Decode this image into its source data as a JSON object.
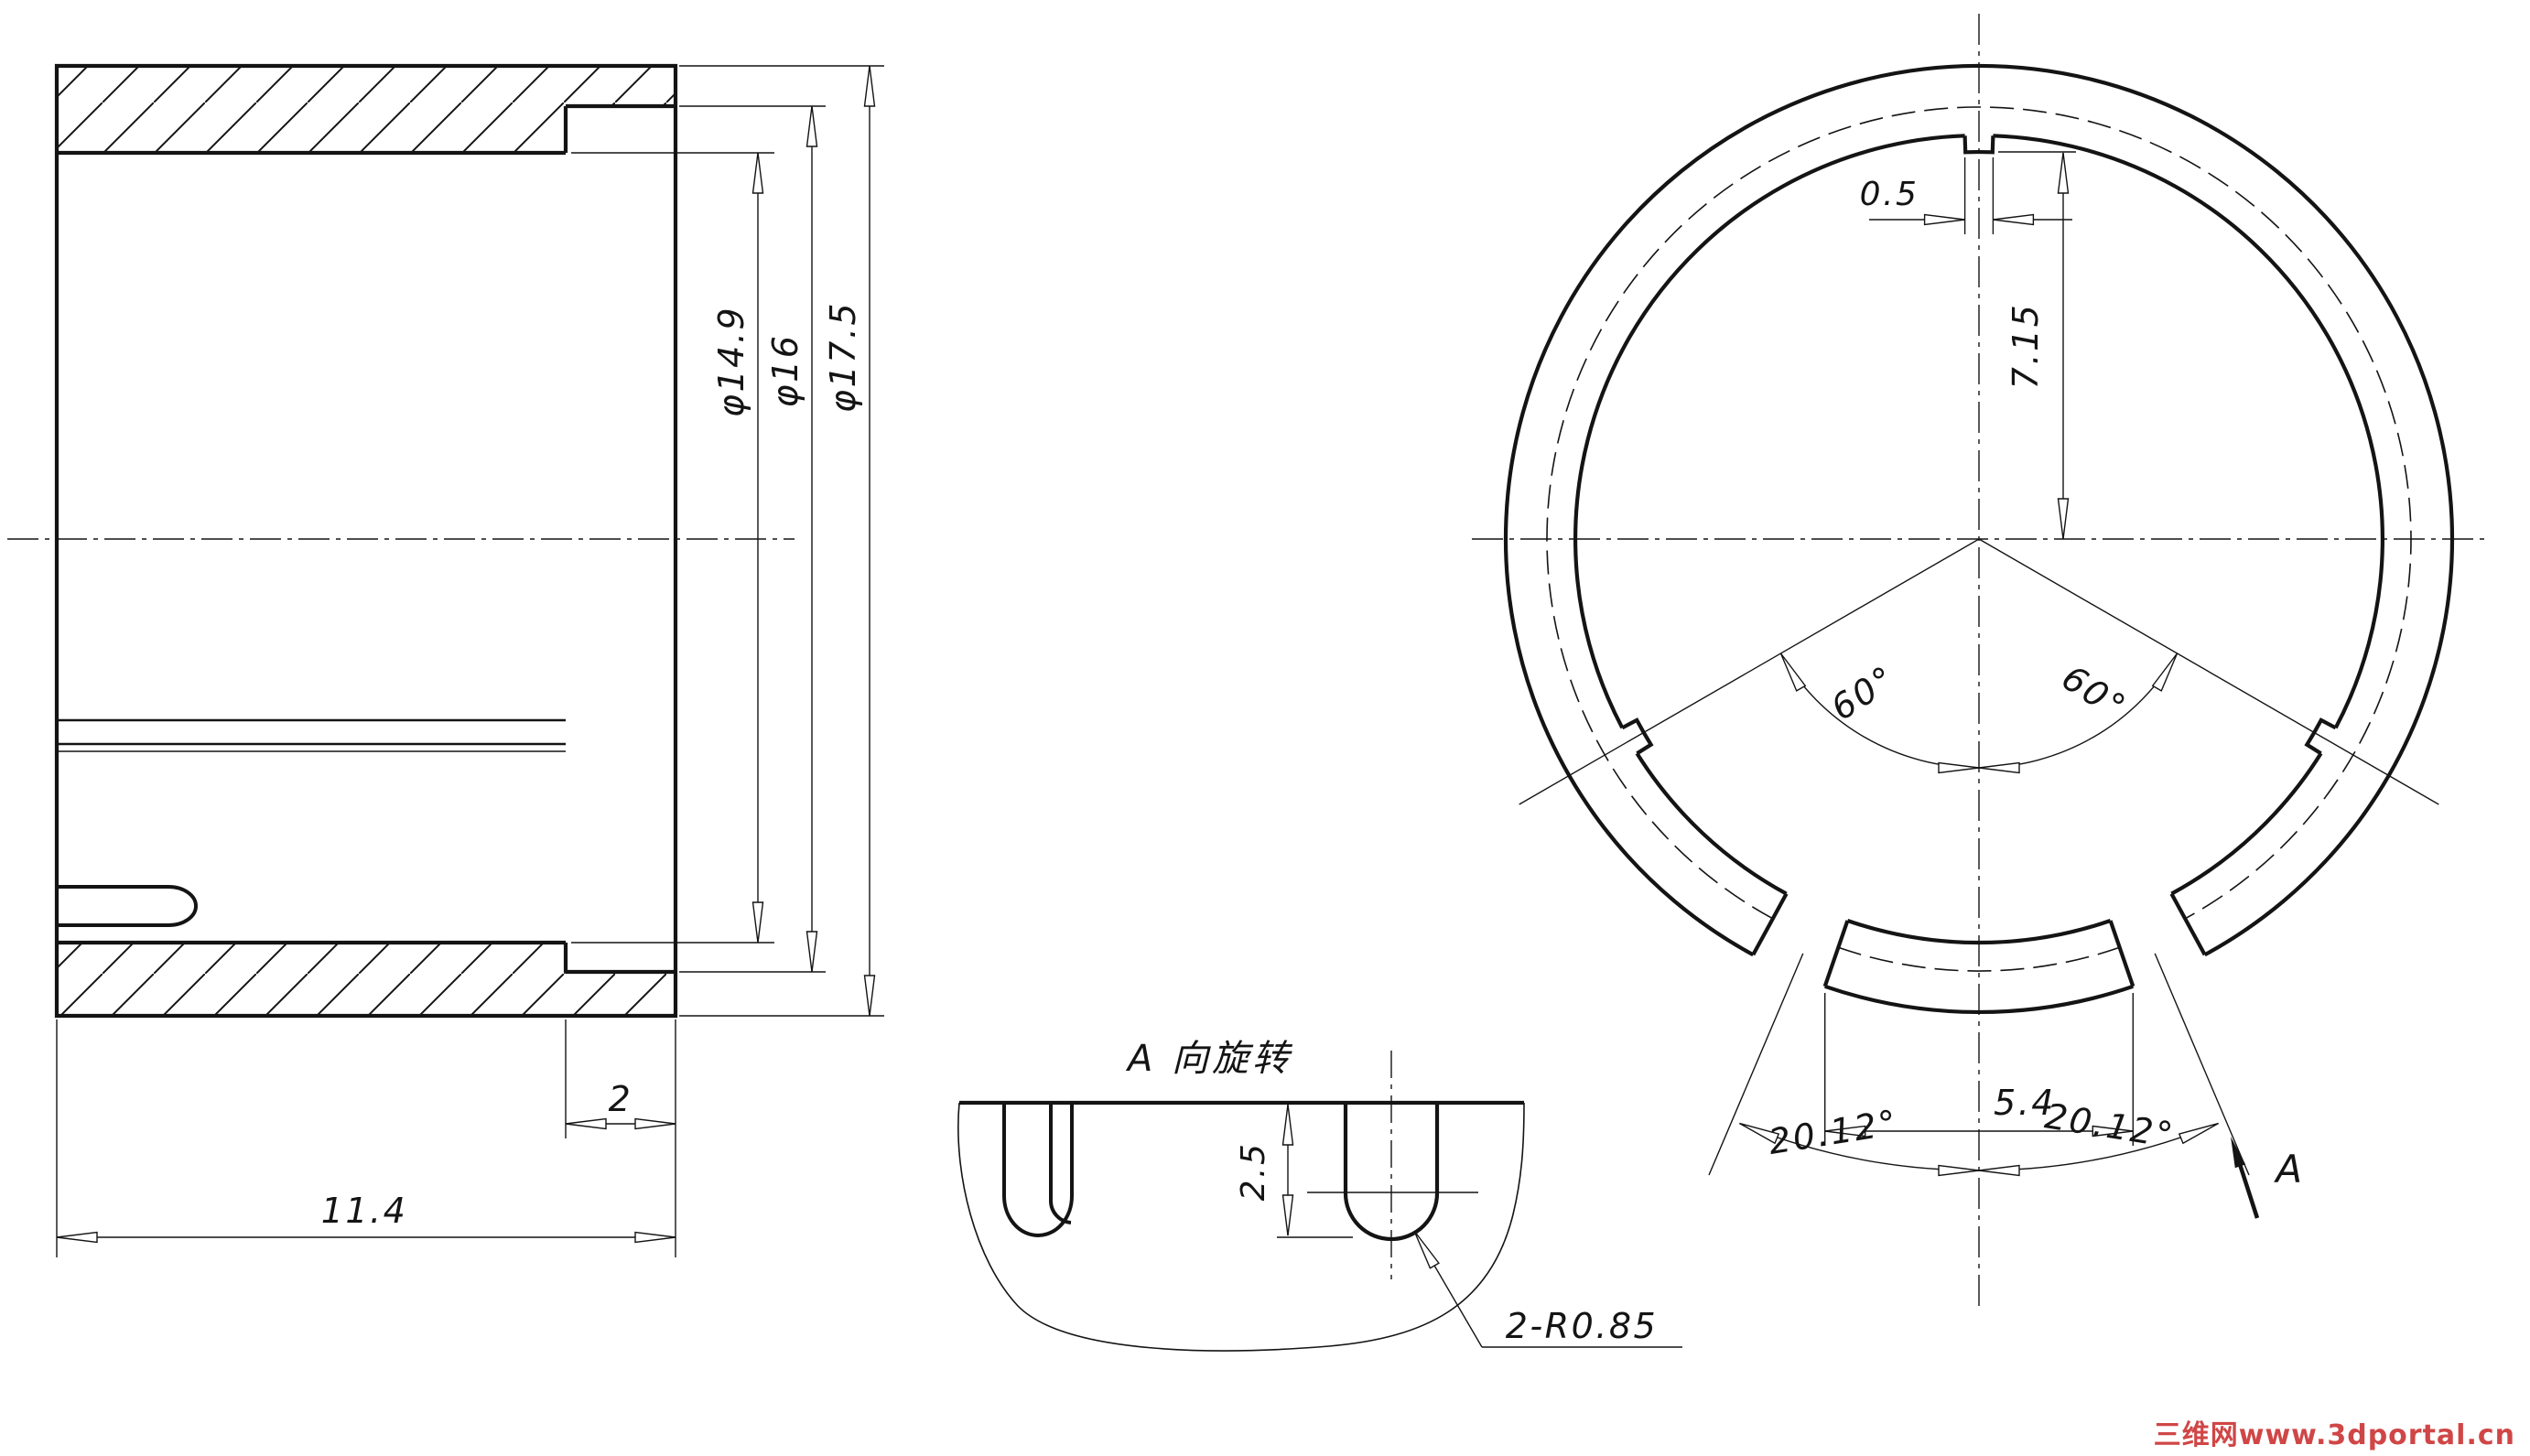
{
  "section_view": {
    "dim_overall_length": "11.4",
    "dim_flange_width": "2",
    "dim_bore_diameter": "φ14.9",
    "dim_counterbore_diameter": "φ16",
    "dim_outer_diameter": "φ17.5"
  },
  "end_view": {
    "dim_tab_width": "0.5",
    "dim_tab_radius": "7.15",
    "dim_angle_left": "60°",
    "dim_angle_right": "60°",
    "dim_slot_span": "5.4",
    "dim_slot_angle_left": "20.12°",
    "dim_slot_angle_right": "20.12°",
    "view_arrow_label": "A"
  },
  "detail_view": {
    "title": "A 向旋转",
    "dim_slot_depth": "2.5",
    "dim_slot_radius": "2-R0.85"
  },
  "watermark": {
    "text": "三维网www.3dportal.cn",
    "color": "#cc3333"
  },
  "colors": {
    "ink": "#141414",
    "background": "#ffffff"
  }
}
